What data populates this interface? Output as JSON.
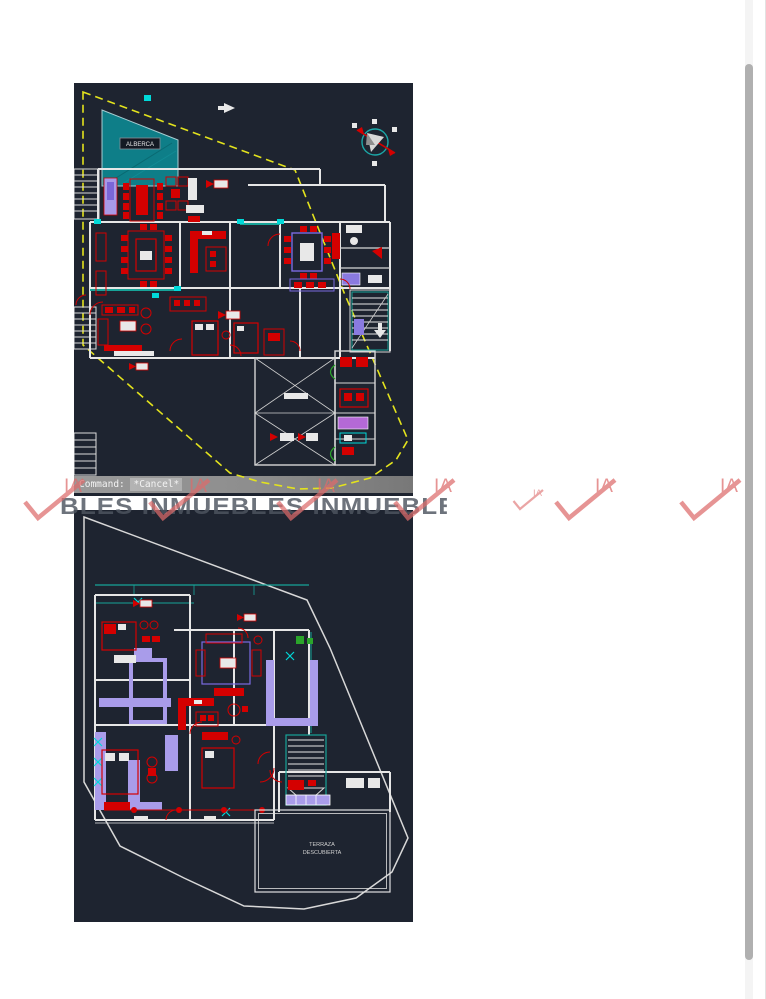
{
  "command_bar": {
    "prefix": "Command: ",
    "value": "*Cancel*"
  },
  "ground_floor_plan": {
    "pool_label": "ALBERCA"
  },
  "upper_floor_plan": {
    "terrace_label_line1": "TERRAZA",
    "terrace_label_line2": "DESCUBIERTA"
  },
  "watermark": {
    "logo_text": "IA",
    "row_text": "BLES INMUEBLES INMUEBLES IN",
    "color": "#dd6b6b"
  },
  "colors": {
    "canvas": "#1e2430",
    "boundary_yellow": "#e3e31d",
    "boundary_white": "#d8d8d8",
    "wall_white": "#e6e6e6",
    "furniture_red": "#d40000",
    "pool_teal": "#0e7e88",
    "accent_teal": "#17a398",
    "accent_cyan": "#00d9d9",
    "accent_purple": "#a99cea",
    "accent_violet": "#7a6ae0",
    "accent_magenta": "#b469d6",
    "accent_green": "#2ba52b",
    "command_bar_gray": "#8d8d8d"
  }
}
